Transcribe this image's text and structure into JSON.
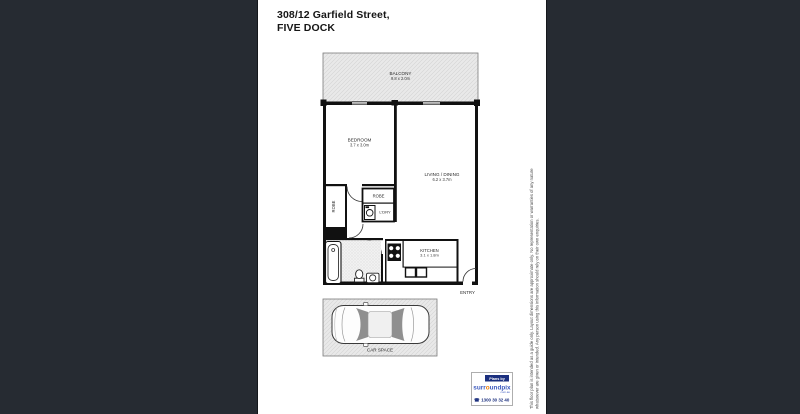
{
  "colors": {
    "background": "#262b32",
    "page": "#ffffff",
    "walls": "#111111",
    "zone_fill": "#e9e9e9",
    "brand_blue": "#3d5abe",
    "brand_navy": "#1b2f7e",
    "brand_orange": "#ef7d00"
  },
  "header": {
    "title_line1": "308/12 Garfield Street,",
    "title_line2": "FIVE DOCK"
  },
  "rooms": {
    "balcony": {
      "name": "BALCONY",
      "dims": "9.8 x 2.0m"
    },
    "bedroom": {
      "name": "BEDROOM",
      "dims": "3.7 x 3.0m"
    },
    "living_dining": {
      "name": "LIVING / DINING",
      "dims": "6.2 x 3.7m"
    },
    "robe_bedroom": {
      "name": "ROBE"
    },
    "robe_hall": {
      "name": "ROBE"
    },
    "laundry": {
      "name": "L'DRY"
    },
    "bathroom": {
      "name": "BATHROOM",
      "dims": "2.4 x 1.9m"
    },
    "kitchen": {
      "name": "KITCHEN",
      "dims": "3.1 x 1.8m"
    },
    "entry": {
      "name": "ENTRY"
    },
    "car_space": {
      "name": "CAR SPACE"
    }
  },
  "branding": {
    "plans_by": "Plans by",
    "brand_pre": "surr",
    "brand_o": "o",
    "brand_post": "undpix",
    "brand_suffix": "com.au",
    "phone_icon": "☎",
    "phone": "1300 30 32 40"
  },
  "disclaimer": {
    "line1": "This floor plan is intended as a guide only. Layout dimensions are approximate only. No representation or warranties of any nature",
    "line2": "whatsoever are given or intended. Any person using this information should rely on their own enquiries."
  }
}
